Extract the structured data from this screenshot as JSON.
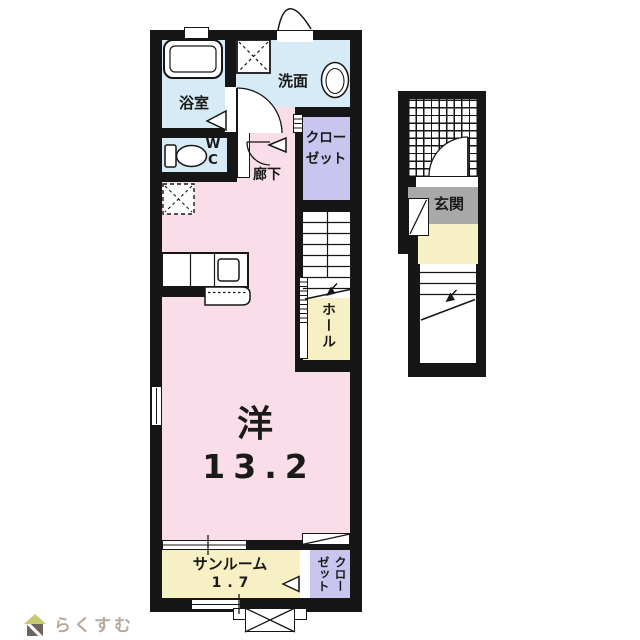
{
  "palette": {
    "wall": "#161616",
    "room_pink": "#f9dde9",
    "wet_area_blue": "#d7ebf6",
    "closet_purple": "#c8c5ee",
    "hall_yellow": "#f7f0c4",
    "entrance_gray": "#a9a9a9",
    "logo_text": "#b6a89b",
    "logo_roof": "#c6ca70",
    "logo_body": "#6e665c"
  },
  "labels": {
    "bathroom": "浴室",
    "washroom": "洗面",
    "wc": "WC",
    "closet_upper": {
      "line1": "クロー",
      "line2": "ゼット"
    },
    "hallway": "廊下",
    "hall": "ホール",
    "room": {
      "type": "洋",
      "size": "13.2"
    },
    "sunroom": {
      "name": "サンルーム",
      "size": "1.7"
    },
    "closet_lower": {
      "col_right": "クロー",
      "col_left": "ゼット"
    },
    "entrance": "玄関"
  },
  "icons": {
    "bathtub-icon": "rounded rectangle tub",
    "toilet-icon": "tank + oval bowl",
    "washbasin-icon": "double oval basin",
    "washer-space-icon": "square with dashed X",
    "refrigerator-space-icon": "dashed square with dashed X",
    "kitchen-counter-icon": "counter with stove square",
    "door-swing-icon": "quarter-circle arc",
    "folding-door-icon": "left-pointing triangle",
    "stairs-icon": "parallel treads with down arrow",
    "tile-porch-icon": "square grid hatch",
    "ac-outdoor-unit-icon": "rectangle with X",
    "house-logo-icon": "roof triangle over striped square"
  },
  "logo": {
    "text": "らくすむ"
  }
}
